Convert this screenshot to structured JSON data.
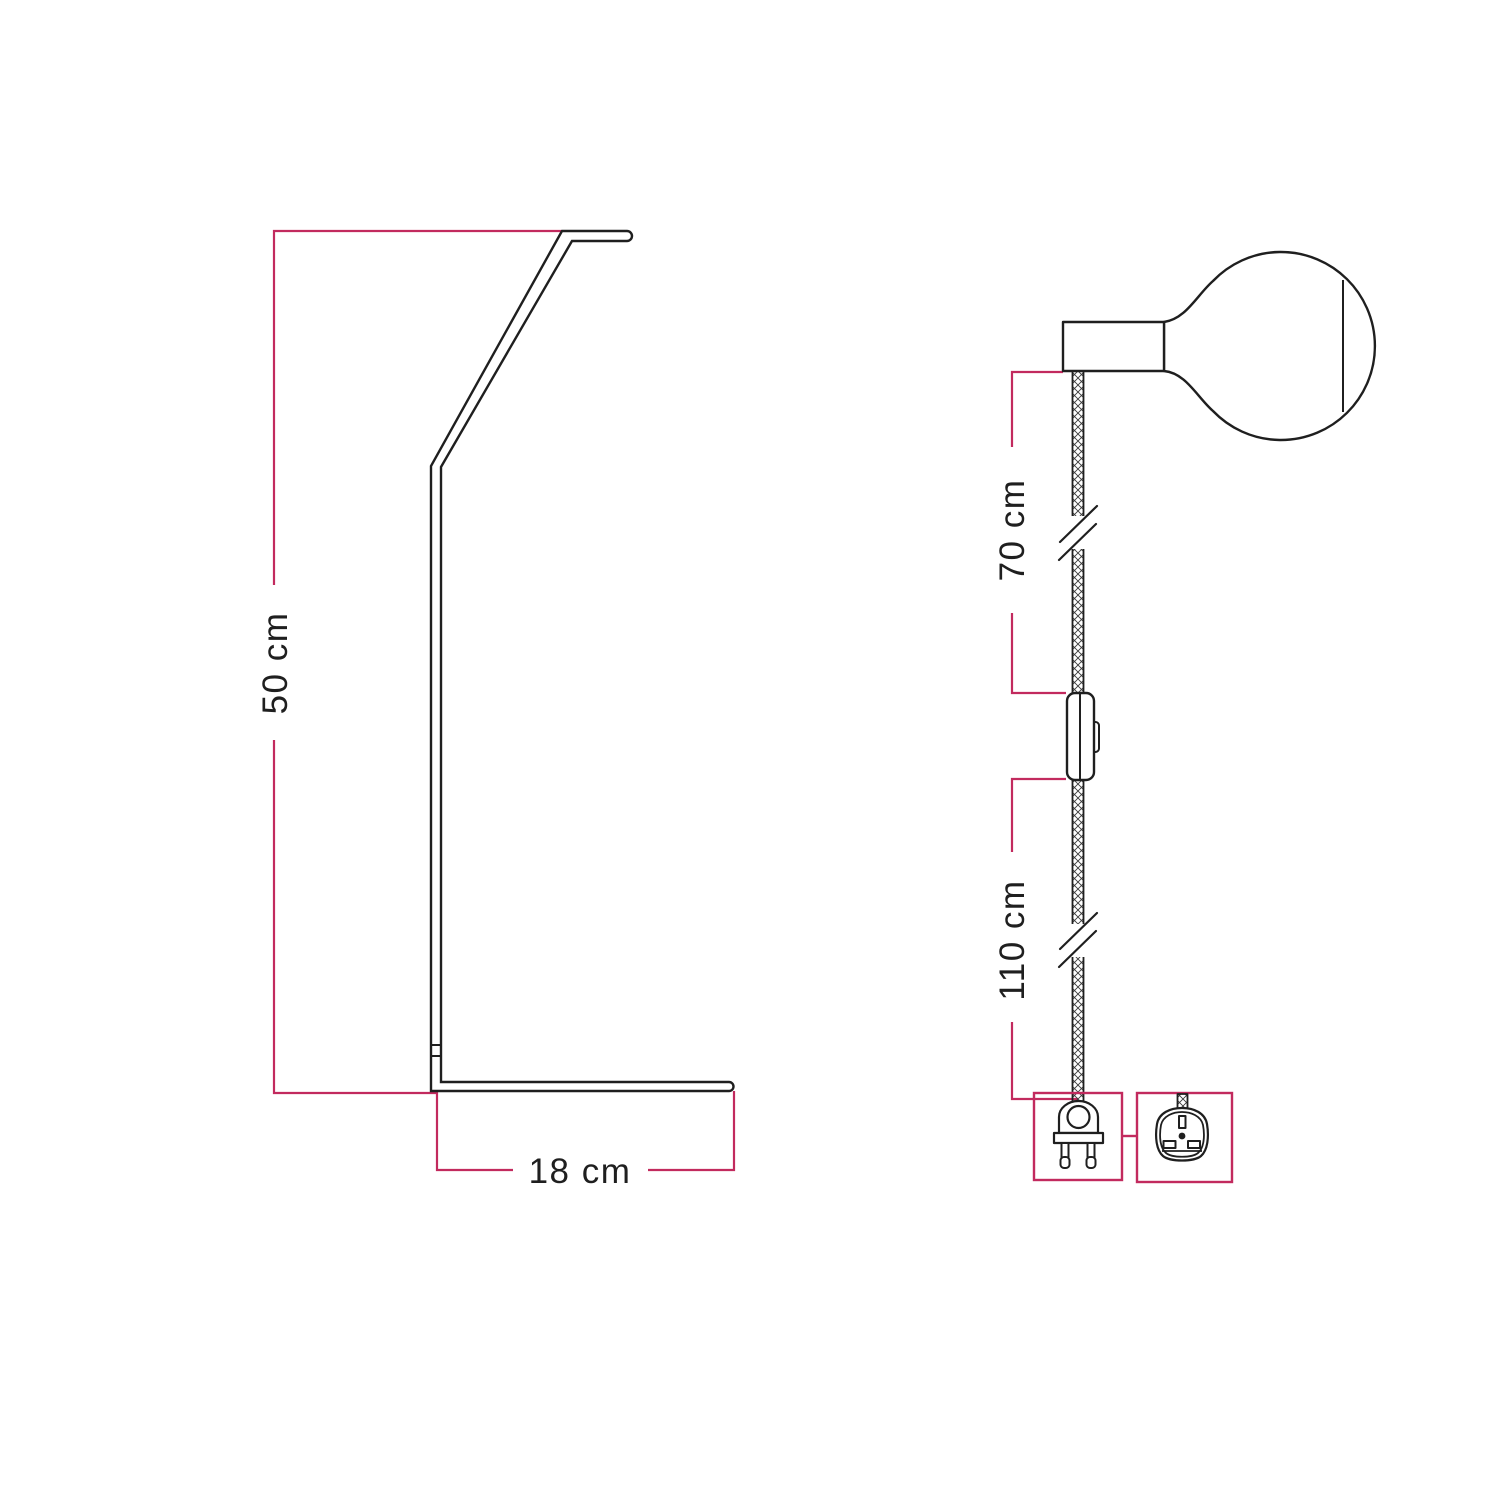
{
  "dimensions": {
    "stand_height": "50 cm",
    "stand_base_depth": "18 cm",
    "cable_bulb_to_switch": "70 cm",
    "cable_switch_to_plug": "110 cm"
  },
  "colors": {
    "accent": "#c22a5e",
    "outline": "#1f1f1f",
    "background": "#ffffff"
  }
}
